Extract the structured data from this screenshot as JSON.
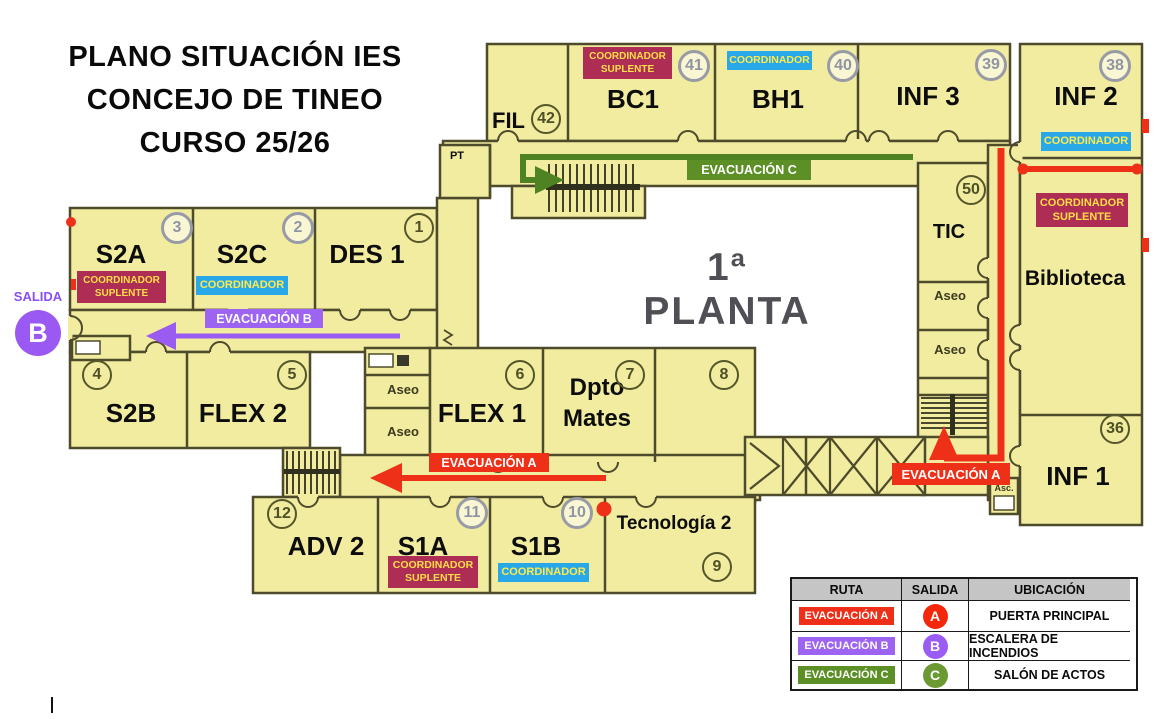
{
  "window": {
    "width": 1157,
    "height": 719,
    "background": "#ffffff"
  },
  "title": {
    "line1": "PLANO SITUACIÓN IES",
    "line2": "CONCEJO DE TINEO",
    "line3": "CURSO 25/26"
  },
  "plan": {
    "floor_label": "1ª PLANTA",
    "rooms": {
      "fil": "FIL",
      "bc1": "BC1",
      "bh1": "BH1",
      "inf3": "INF 3",
      "inf2": "INF 2",
      "tic": "TIC",
      "biblioteca": "Biblioteca",
      "inf1": "INF 1",
      "s2a": "S2A",
      "s2c": "S2C",
      "des1": "DES 1",
      "s2b": "S2B",
      "flex2": "FLEX 2",
      "flex1": "FLEX 1",
      "dpto_line1": "Dpto",
      "dpto_line2": "Mates",
      "adv2": "ADV 2",
      "s1a": "S1A",
      "s1b": "S1B",
      "tecnologia2": "Tecnología 2",
      "pt": "PT",
      "aseo": "Aseo",
      "asc": "Asc."
    },
    "numbers": {
      "n1": "1",
      "n2": "2",
      "n3": "3",
      "n4": "4",
      "n5": "5",
      "n6": "6",
      "n7": "7",
      "n8": "8",
      "n9": "9",
      "n10": "10",
      "n11": "11",
      "n12": "12",
      "n36": "36",
      "n38": "38",
      "n39": "39",
      "n40": "40",
      "n41": "41",
      "n42": "42",
      "n50": "50"
    }
  },
  "badges": {
    "coordinador": "COORDINADOR",
    "suplente": "SUPLENTE"
  },
  "routes": {
    "a": {
      "label": "EVACUACIÓN A",
      "color": "#ee3018"
    },
    "b": {
      "label": "EVACUACIÓN B",
      "color": "#9d64f2"
    },
    "c": {
      "label": "EVACUACIÓN C",
      "color": "#5c9026"
    }
  },
  "exit_b": {
    "label": "SALIDA",
    "letter": "B",
    "color": "#9b59f3"
  },
  "legend": {
    "headers": [
      "RUTA",
      "SALIDA",
      "UBICACIÓN"
    ],
    "rows": [
      {
        "route": "EVACUACIÓN A",
        "letter": "A",
        "location": "PUERTA PRINCIPAL",
        "badge_color": "#ee3018",
        "circle_color": "#f5270b"
      },
      {
        "route": "EVACUACIÓN B",
        "letter": "B",
        "location": "ESCALERA DE INCENDIOS",
        "badge_color": "#9d64f2",
        "circle_color": "#9a5cf5"
      },
      {
        "route": "EVACUACIÓN C",
        "letter": "C",
        "location": "SALÓN DE ACTOS",
        "badge_color": "#5c9026",
        "circle_color": "#6a9a31"
      }
    ]
  }
}
